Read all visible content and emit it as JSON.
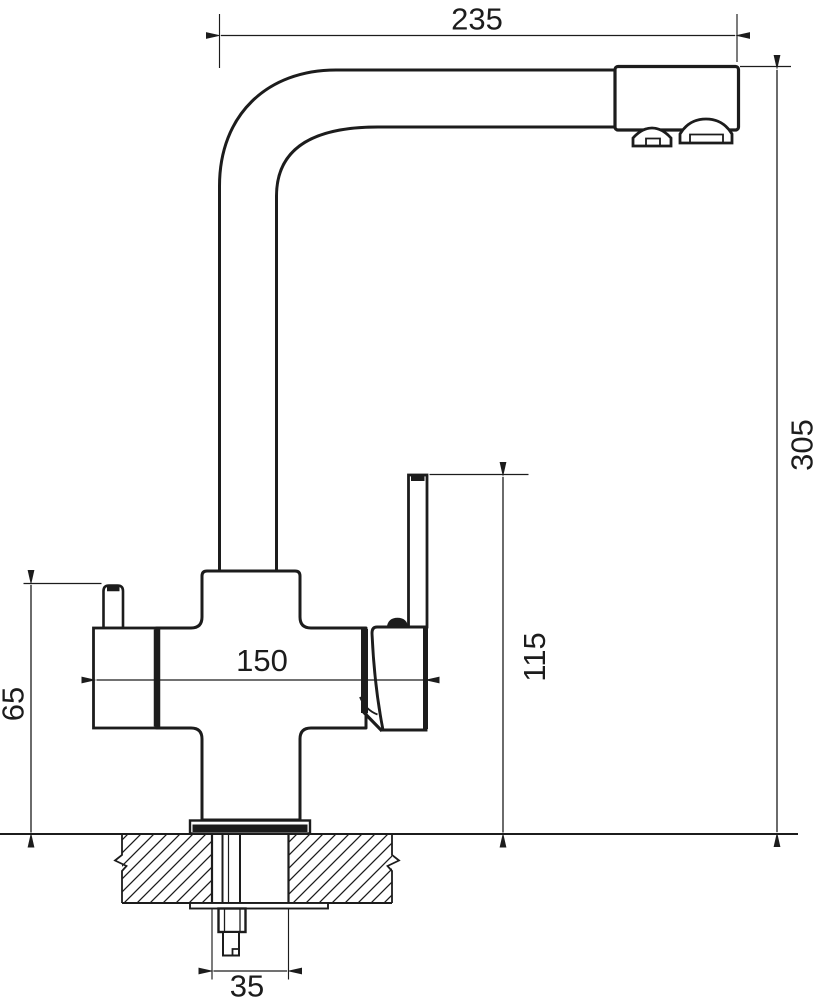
{
  "colors": {
    "line": "#1c1c1c",
    "background": "#ffffff"
  },
  "dimensions": {
    "top_width": "235",
    "overall_height": "305",
    "handle_span": "150",
    "left_handle_height": "65",
    "lever_top_height": "115",
    "mounting_hole_width": "35"
  }
}
